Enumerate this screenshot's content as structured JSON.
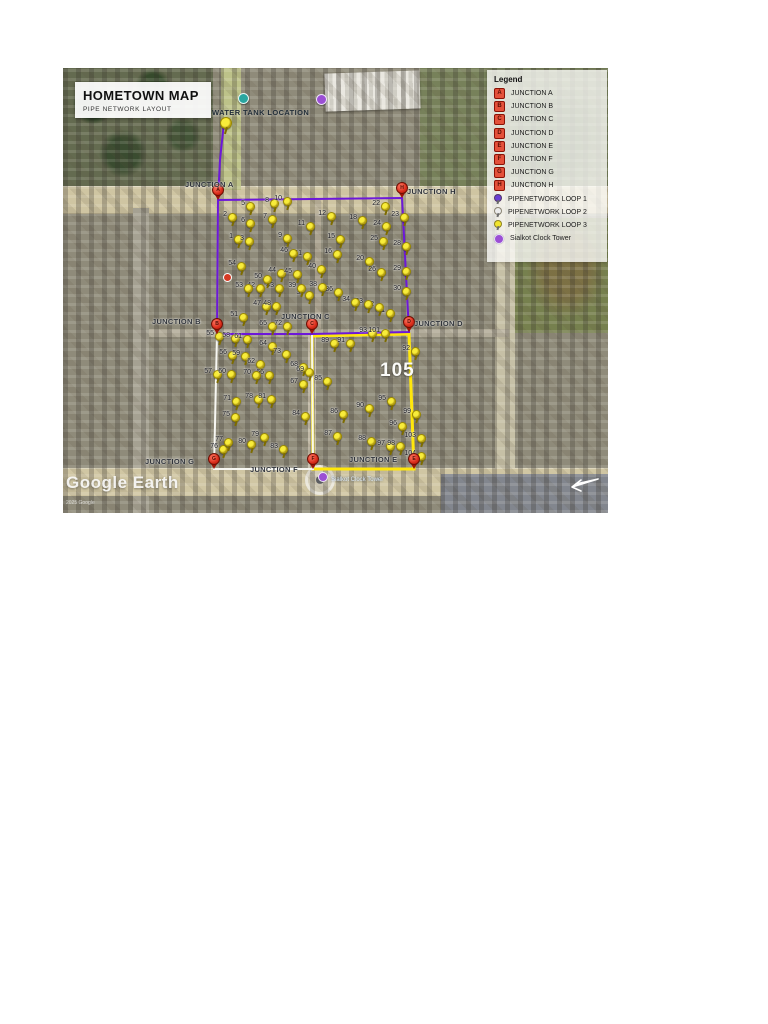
{
  "title_box": {
    "title": "HOMETOWN MAP",
    "subtitle": "PIPE NETWORK LAYOUT"
  },
  "legend": {
    "title": "Legend",
    "items": [
      {
        "icon": "junction",
        "letter": "A",
        "label": "JUNCTION A"
      },
      {
        "icon": "junction",
        "letter": "B",
        "label": "JUNCTION B"
      },
      {
        "icon": "junction",
        "letter": "C",
        "label": "JUNCTION C"
      },
      {
        "icon": "junction",
        "letter": "D",
        "label": "JUNCTION D"
      },
      {
        "icon": "junction",
        "letter": "E",
        "label": "JUNCTION E"
      },
      {
        "icon": "junction",
        "letter": "F",
        "label": "JUNCTION F"
      },
      {
        "icon": "junction",
        "letter": "G",
        "label": "JUNCTION G"
      },
      {
        "icon": "junction",
        "letter": "H",
        "label": "JUNCTION H"
      },
      {
        "icon": "pin",
        "color": "#6a3fd4",
        "label": "PIPENETWORK LOOP 1"
      },
      {
        "icon": "pin",
        "color": "#ececec",
        "label": "PIPENETWORK LOOP 2"
      },
      {
        "icon": "pin",
        "color": "#f2e52e",
        "label": "PIPENETWORK LOOP 3"
      },
      {
        "icon": "tower",
        "color": "#9b4fd4",
        "label": "Sialkot Clock Tower"
      }
    ]
  },
  "map": {
    "water_tank_label": "WATER TANK LOCATION",
    "clock_tower_label": "Sialkot Clock Tower",
    "big_label": "105",
    "watermark": "Google Earth",
    "copyright": "2025 Google",
    "colors": {
      "loop1": "#6d18d9",
      "loop2": "#f7f7f2",
      "loop3": "#ffe70a",
      "junction_pin": "#d92c1a",
      "yellow_pin": "#f8ec3a"
    },
    "water_tank_pin": {
      "x": 161,
      "y": 54
    },
    "loops": [
      {
        "name": "pipeloop-3",
        "color": "#ffe70a",
        "width": 3,
        "points": "249,268 346,266 351,401 250,401 249,268"
      },
      {
        "name": "pipeloop-2",
        "color": "#f7f7f2",
        "width": 2,
        "points": "154,266 249,266 250,401 151,401 154,266"
      },
      {
        "name": "pipeloop-1",
        "color": "#6d18d9",
        "width": 2,
        "points": "155,132 339,130 346,264 249,266 154,266 155,132"
      },
      {
        "name": "water-supply-line",
        "color": "#6d18d9",
        "width": 2,
        "points": "161,54 157,92 155,132"
      }
    ],
    "junctions": [
      {
        "letter": "A",
        "label": "JUNCTION A",
        "x": 155,
        "y": 132,
        "lx": 122,
        "ly": 112
      },
      {
        "letter": "H",
        "label": "JUNCTION H",
        "x": 339,
        "y": 130,
        "lx": 344,
        "ly": 119
      },
      {
        "letter": "B",
        "label": "JUNCTION B",
        "x": 154,
        "y": 266,
        "lx": 89,
        "ly": 249
      },
      {
        "letter": "C",
        "label": "JUNCTION C",
        "x": 249,
        "y": 266,
        "lx": 218,
        "ly": 244
      },
      {
        "letter": "D",
        "label": "JUNCTION D",
        "x": 346,
        "y": 264,
        "lx": 351,
        "ly": 251
      },
      {
        "letter": "G",
        "label": "JUNCTION G",
        "x": 151,
        "y": 401,
        "lx": 82,
        "ly": 389
      },
      {
        "letter": "F",
        "label": "JUNCTION F",
        "x": 250,
        "y": 401,
        "lx": 187,
        "ly": 397
      },
      {
        "letter": "E",
        "label": "JUNCTION E",
        "x": 351,
        "y": 401,
        "lx": 286,
        "ly": 387
      }
    ],
    "pins": [
      {
        "n": 1,
        "x": 175,
        "y": 172
      },
      {
        "n": 2,
        "x": 169,
        "y": 150
      },
      {
        "n": 3,
        "x": 186,
        "y": 174
      },
      {
        "n": 5,
        "x": 187,
        "y": 139
      },
      {
        "n": 6,
        "x": 187,
        "y": 156
      },
      {
        "n": 7,
        "x": 209,
        "y": 152
      },
      {
        "n": 8,
        "x": 211,
        "y": 136
      },
      {
        "n": 9,
        "x": 224,
        "y": 171
      },
      {
        "n": 10,
        "x": 224,
        "y": 134
      },
      {
        "n": 11,
        "x": 247,
        "y": 159
      },
      {
        "n": 12,
        "x": 268,
        "y": 149
      },
      {
        "n": 15,
        "x": 277,
        "y": 172
      },
      {
        "n": 16,
        "x": 274,
        "y": 187
      },
      {
        "n": 18,
        "x": 299,
        "y": 153
      },
      {
        "n": 20,
        "x": 306,
        "y": 194
      },
      {
        "n": 22,
        "x": 322,
        "y": 139
      },
      {
        "n": 23,
        "x": 341,
        "y": 150
      },
      {
        "n": 24,
        "x": 323,
        "y": 159
      },
      {
        "n": 25,
        "x": 320,
        "y": 174
      },
      {
        "n": 26,
        "x": 318,
        "y": 205
      },
      {
        "n": 28,
        "x": 343,
        "y": 179
      },
      {
        "n": 29,
        "x": 343,
        "y": 204
      },
      {
        "n": 30,
        "x": 343,
        "y": 224
      },
      {
        "n": 31,
        "x": 327,
        "y": 246
      },
      {
        "n": 32,
        "x": 316,
        "y": 240
      },
      {
        "n": 33,
        "x": 305,
        "y": 237
      },
      {
        "n": 34,
        "x": 292,
        "y": 235
      },
      {
        "n": 36,
        "x": 275,
        "y": 225
      },
      {
        "n": 37,
        "x": 246,
        "y": 228
      },
      {
        "n": 38,
        "x": 259,
        "y": 220
      },
      {
        "n": 39,
        "x": 238,
        "y": 221
      },
      {
        "n": 40,
        "x": 258,
        "y": 202
      },
      {
        "n": 41,
        "x": 244,
        "y": 189
      },
      {
        "n": 42,
        "x": 197,
        "y": 221
      },
      {
        "n": 43,
        "x": 216,
        "y": 221
      },
      {
        "n": 44,
        "x": 218,
        "y": 206
      },
      {
        "n": 45,
        "x": 234,
        "y": 207
      },
      {
        "n": 46,
        "x": 230,
        "y": 186
      },
      {
        "n": 47,
        "x": 203,
        "y": 239
      },
      {
        "n": 48,
        "x": 213,
        "y": 239
      },
      {
        "n": 50,
        "x": 204,
        "y": 212
      },
      {
        "n": 51,
        "x": 180,
        "y": 250
      },
      {
        "n": 53,
        "x": 185,
        "y": 221
      },
      {
        "n": 54,
        "x": 178,
        "y": 199
      },
      {
        "n": 55,
        "x": 156,
        "y": 269
      },
      {
        "n": 56,
        "x": 169,
        "y": 288
      },
      {
        "n": 57,
        "x": 154,
        "y": 307
      },
      {
        "n": 58,
        "x": 172,
        "y": 271
      },
      {
        "n": 59,
        "x": 182,
        "y": 289
      },
      {
        "n": 60,
        "x": 168,
        "y": 307
      },
      {
        "n": 61,
        "x": 184,
        "y": 272
      },
      {
        "n": 62,
        "x": 197,
        "y": 297
      },
      {
        "n": 64,
        "x": 209,
        "y": 279
      },
      {
        "n": 65,
        "x": 209,
        "y": 259
      },
      {
        "n": 66,
        "x": 206,
        "y": 308
      },
      {
        "n": 67,
        "x": 240,
        "y": 317
      },
      {
        "n": 68,
        "x": 240,
        "y": 300
      },
      {
        "n": 69,
        "x": 246,
        "y": 305
      },
      {
        "n": 70,
        "x": 193,
        "y": 308
      },
      {
        "n": 71,
        "x": 173,
        "y": 334
      },
      {
        "n": 72,
        "x": 224,
        "y": 259
      },
      {
        "n": 73,
        "x": 223,
        "y": 287
      },
      {
        "n": 75,
        "x": 172,
        "y": 350
      },
      {
        "n": 76,
        "x": 160,
        "y": 382
      },
      {
        "n": 77,
        "x": 165,
        "y": 375
      },
      {
        "n": 78,
        "x": 195,
        "y": 332
      },
      {
        "n": 79,
        "x": 201,
        "y": 370
      },
      {
        "n": 80,
        "x": 188,
        "y": 377
      },
      {
        "n": 81,
        "x": 208,
        "y": 332
      },
      {
        "n": 83,
        "x": 220,
        "y": 382
      },
      {
        "n": 84,
        "x": 242,
        "y": 349
      },
      {
        "n": 85,
        "x": 264,
        "y": 314
      },
      {
        "n": 86,
        "x": 280,
        "y": 347
      },
      {
        "n": 87,
        "x": 274,
        "y": 369
      },
      {
        "n": 88,
        "x": 308,
        "y": 374
      },
      {
        "n": 89,
        "x": 271,
        "y": 276
      },
      {
        "n": 90,
        "x": 306,
        "y": 341
      },
      {
        "n": 91,
        "x": 287,
        "y": 276
      },
      {
        "n": 92,
        "x": 352,
        "y": 284
      },
      {
        "n": 93,
        "x": 309,
        "y": 266
      },
      {
        "n": 95,
        "x": 328,
        "y": 334
      },
      {
        "n": 96,
        "x": 339,
        "y": 359
      },
      {
        "n": 97,
        "x": 327,
        "y": 379
      },
      {
        "n": 98,
        "x": 337,
        "y": 379
      },
      {
        "n": 99,
        "x": 353,
        "y": 347
      },
      {
        "n": 101,
        "x": 322,
        "y": 266
      },
      {
        "n": 103,
        "x": 358,
        "y": 371
      },
      {
        "n": 104,
        "x": 358,
        "y": 389
      }
    ]
  }
}
